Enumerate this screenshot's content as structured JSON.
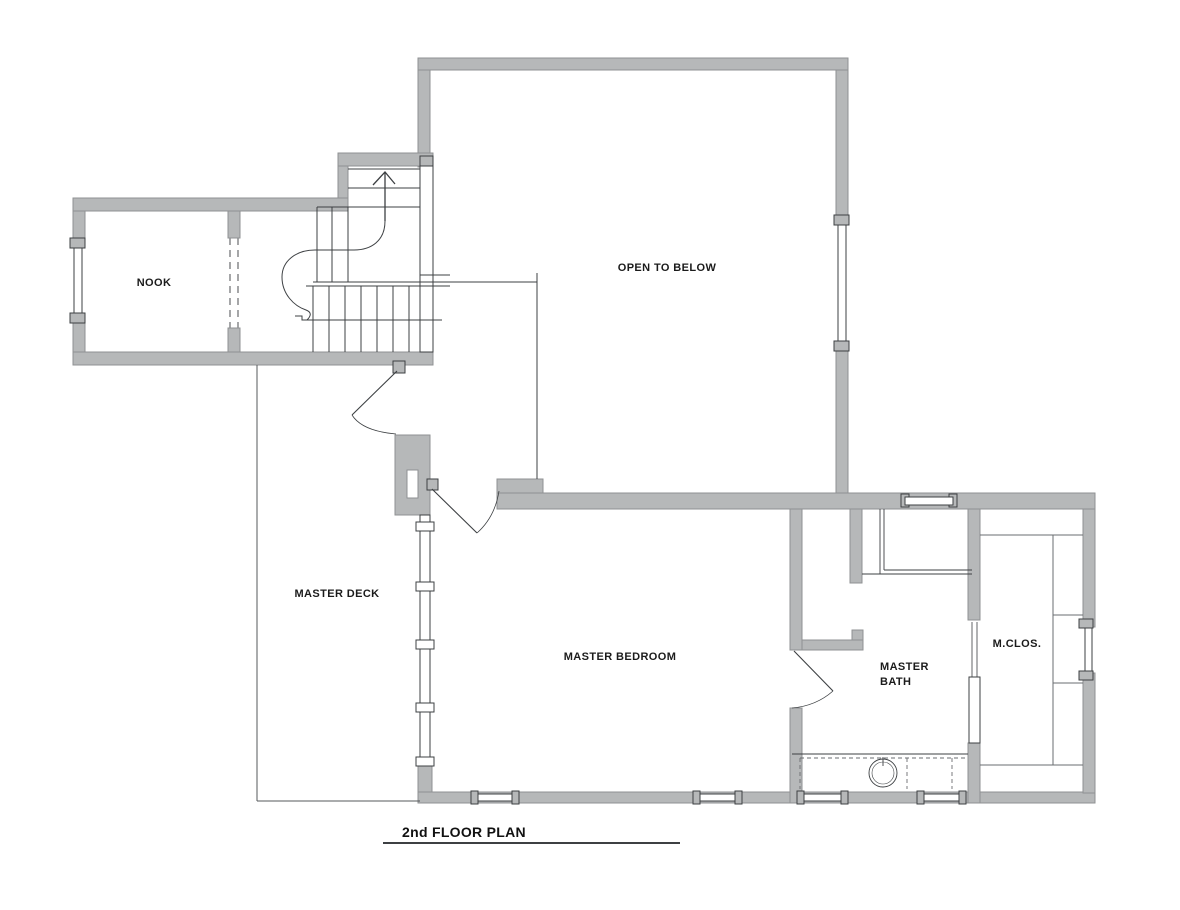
{
  "plan": {
    "title": "2nd FLOOR PLAN",
    "rooms": {
      "nook": "NOOK",
      "open_to_below": "OPEN TO BELOW",
      "master_deck": "MASTER DECK",
      "master_bedroom": "MASTER BEDROOM",
      "master_bath_line1": "MASTER",
      "master_bath_line2": "BATH",
      "master_closet": "M.CLOS."
    },
    "icons": {
      "stair_direction_arrow": "up-arrow"
    },
    "colors": {
      "wall_fill": "#b6b8b9",
      "wall_edge": "#8f9193",
      "line": "#3d4043",
      "railing": "#55585b",
      "text": "#1b1b1b",
      "background": "#ffffff"
    }
  }
}
